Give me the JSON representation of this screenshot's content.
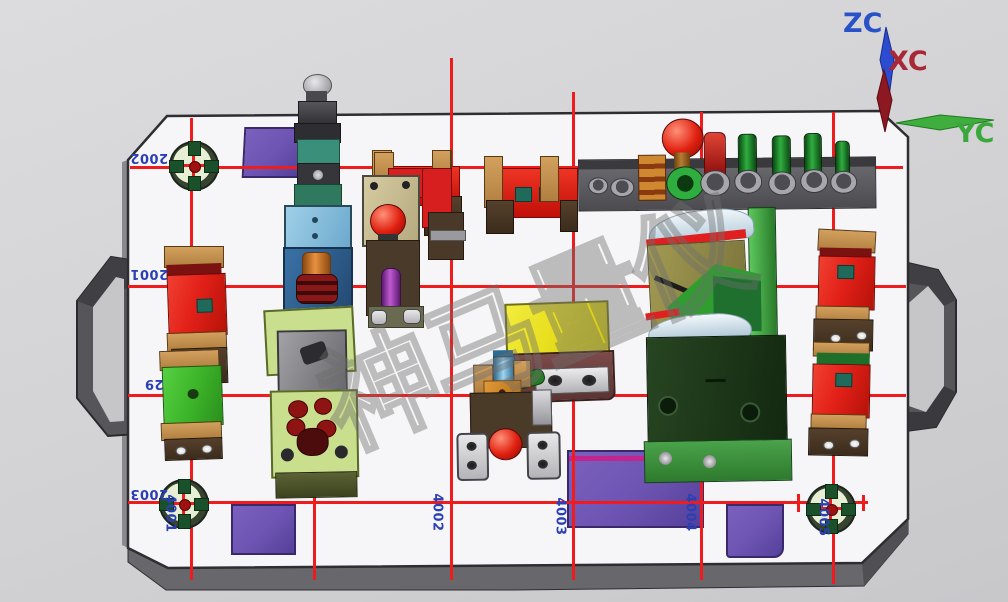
{
  "axis_triad": {
    "z": "ZC",
    "x": "XC",
    "y": "YC"
  },
  "watermark": {
    "text": "神马量仪"
  },
  "grid": {
    "h_labels": [
      "2002",
      "2001",
      "29",
      "2003"
    ],
    "v_labels": [
      "4001",
      "4002",
      "4003",
      "4004",
      "4005"
    ]
  },
  "colors": {
    "grid_line": "#ee1c1c",
    "label_blue": "#2b3fb5",
    "axis_z": "#2a52c8",
    "axis_x": "#a82838",
    "axis_y": "#3aa83a",
    "purple_block": "#6f55b3",
    "red_block": "#e32119",
    "green_block": "#3db52a",
    "yellow_plate": "#e8df1f"
  }
}
